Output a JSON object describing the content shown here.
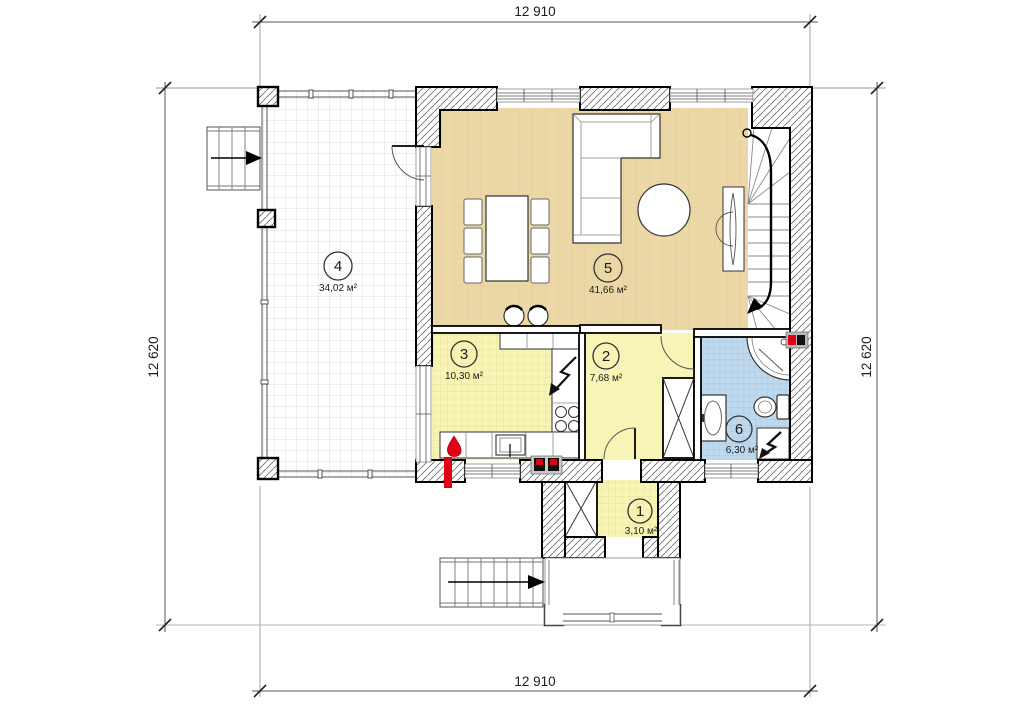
{
  "drawing": {
    "type": "architectural-floor-plan",
    "dimensions": {
      "top": "12 910",
      "bottom": "12 910",
      "left": "12 620",
      "right": "12 620"
    },
    "rooms": [
      {
        "number": "1",
        "area": "3,10 м²",
        "kind": "entry-tambour"
      },
      {
        "number": "2",
        "area": "7,68 м²",
        "kind": "hall"
      },
      {
        "number": "3",
        "area": "10,30 м²",
        "kind": "kitchen"
      },
      {
        "number": "4",
        "area": "34,02 м²",
        "kind": "terrace"
      },
      {
        "number": "5",
        "area": "41,66 м²",
        "kind": "living-room"
      },
      {
        "number": "6",
        "area": "6,30 м²",
        "kind": "bathroom"
      }
    ],
    "symbols": [
      "gas-flame-icon",
      "electric-bolt-icon",
      "meter-red-black-icon",
      "stair-direction-arrow"
    ],
    "colors": {
      "living_tan": "#ECD7A6",
      "kitchen_yellow": "#F7F4B6",
      "bathroom_blue": "#BED9EE",
      "accent_red": "#E30016",
      "wall_outline": "#000000",
      "hatch_line": "#6f6f6f"
    }
  }
}
